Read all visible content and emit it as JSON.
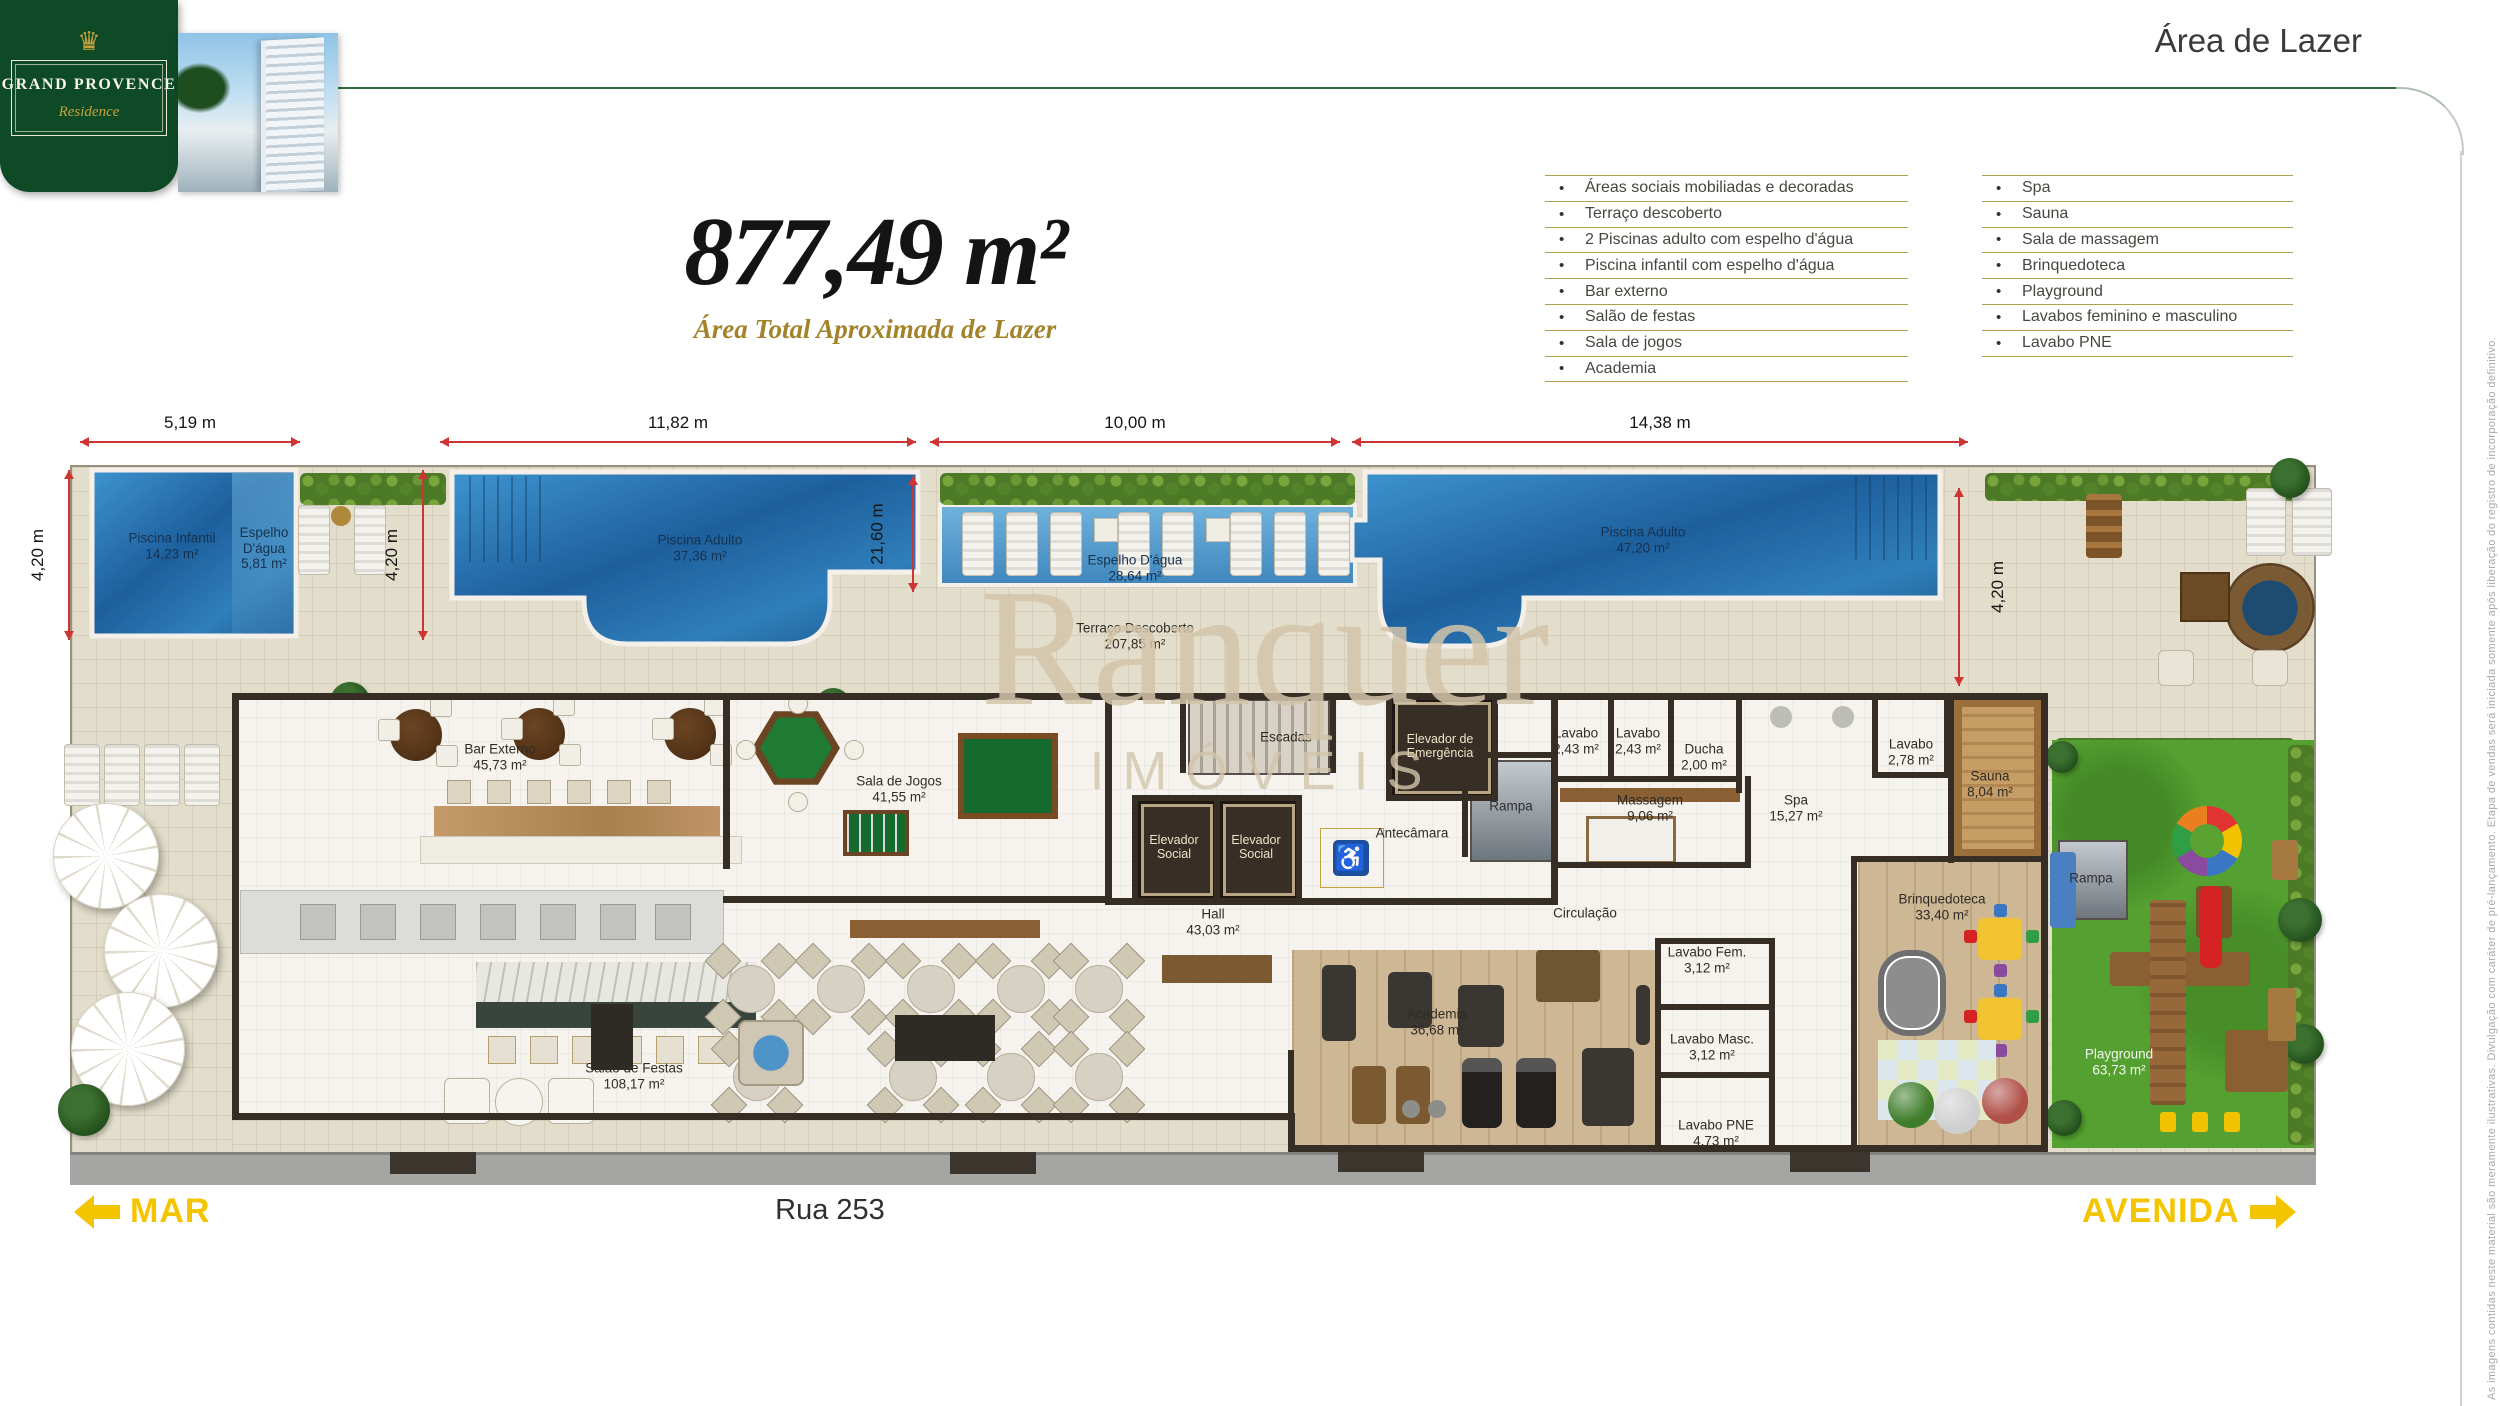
{
  "header": {
    "page_title": "Área de Lazer"
  },
  "logo": {
    "crown_glyph": "♛",
    "brand": "GRAND PROVENCE",
    "residence": "Residence"
  },
  "headline": {
    "total_area": "877,49 m²",
    "caption": "Área Total Aproximada de Lazer"
  },
  "features": {
    "left": [
      "Áreas sociais mobiliadas e decoradas",
      "Terraço descoberto",
      "2 Piscinas adulto com espelho d'água",
      "Piscina infantil com espelho d'água",
      "Bar externo",
      "Salão de festas",
      "Sala de jogos",
      "Academia"
    ],
    "right": [
      "Spa",
      "Sauna",
      "Sala de massagem",
      "Brinquedoteca",
      "Playground",
      "Lavabos feminino e masculino",
      "Lavabo PNE"
    ]
  },
  "dimensions": {
    "top": [
      {
        "label": "5,19 m",
        "x1": 80,
        "x2": 300
      },
      {
        "label": "11,82 m",
        "x1": 440,
        "x2": 916
      },
      {
        "label": "10,00 m",
        "x1": 930,
        "x2": 1340
      },
      {
        "label": "14,38 m",
        "x1": 1352,
        "x2": 1968
      }
    ],
    "vertical": [
      {
        "label": "4,20 m",
        "x": 68,
        "y1": 470,
        "y2": 640,
        "side": "left"
      },
      {
        "label": "4,20 m",
        "x": 422,
        "y1": 470,
        "y2": 640,
        "side": "left"
      },
      {
        "label": "21,60 m",
        "x": 912,
        "y1": 476,
        "y2": 592,
        "side": "left"
      },
      {
        "label": "4,20 m",
        "x": 1958,
        "y1": 488,
        "y2": 686,
        "side": "right"
      }
    ]
  },
  "plan": {
    "rooms": [
      {
        "label": "Piscina Infantil",
        "area": "14,23 m²",
        "x": 172,
        "y": 546,
        "cls": "water"
      },
      {
        "label": "Espelho D'água",
        "area": "5,81 m²",
        "x": 264,
        "y": 548,
        "cls": "water",
        "w": 70
      },
      {
        "label": "Piscina Adulto",
        "area": "37,36 m²",
        "x": 700,
        "y": 548,
        "cls": "water"
      },
      {
        "label": "Espelho D'água",
        "area": "28,64 m²",
        "x": 1135,
        "y": 568,
        "cls": "water"
      },
      {
        "label": "Terraço Descoberto",
        "area": "207,85 m²",
        "x": 1135,
        "y": 636
      },
      {
        "label": "Piscina Adulto",
        "area": "47,20 m²",
        "x": 1643,
        "y": 540,
        "cls": "water"
      },
      {
        "label": "Bar Externo",
        "area": "45,73 m²",
        "x": 500,
        "y": 757
      },
      {
        "label": "Sala de Jogos",
        "area": "41,55 m²",
        "x": 899,
        "y": 789
      },
      {
        "label": "Escadas",
        "x": 1286,
        "y": 737
      },
      {
        "label": "Elevador de Emergência",
        "x": 1440,
        "y": 746,
        "cls": "cream",
        "w": 88
      },
      {
        "label": "Elevador Social",
        "x": 1174,
        "y": 847,
        "cls": "cream",
        "w": 66
      },
      {
        "label": "Elevador Social",
        "x": 1256,
        "y": 847,
        "cls": "cream",
        "w": 66
      },
      {
        "label": "Antecâmara",
        "x": 1412,
        "y": 833
      },
      {
        "label": "Rampa",
        "x": 1511,
        "y": 806,
        "cls": "ramp"
      },
      {
        "label": "Hall",
        "area": "43,03 m²",
        "x": 1213,
        "y": 922
      },
      {
        "label": "Lavabo",
        "area": "2,43 m²",
        "x": 1576,
        "y": 741,
        "w": 60
      },
      {
        "label": "Lavabo",
        "area": "2,43 m²",
        "x": 1638,
        "y": 741,
        "w": 60
      },
      {
        "label": "Ducha",
        "area": "2,00 m²",
        "x": 1704,
        "y": 757,
        "w": 62
      },
      {
        "label": "Massagem",
        "area": "9,06 m²",
        "x": 1650,
        "y": 808
      },
      {
        "label": "Spa",
        "area": "15,27 m²",
        "x": 1796,
        "y": 808
      },
      {
        "label": "Lavabo",
        "area": "2,78 m²",
        "x": 1911,
        "y": 752,
        "w": 60
      },
      {
        "label": "Sauna",
        "area": "8,04 m²",
        "x": 1990,
        "y": 784
      },
      {
        "label": "Circulação",
        "x": 1585,
        "y": 913
      },
      {
        "label": "Brinquedoteca",
        "area": "33,40 m²",
        "x": 1942,
        "y": 907
      },
      {
        "label": "Lavabo Fem.",
        "area": "3,12 m²",
        "x": 1707,
        "y": 960,
        "w": 92
      },
      {
        "label": "Lavabo Masc.",
        "area": "3,12 m²",
        "x": 1712,
        "y": 1047,
        "w": 104
      },
      {
        "label": "Lavabo PNE",
        "area": "4,73 m²",
        "x": 1716,
        "y": 1133,
        "w": 104
      },
      {
        "label": "Academia",
        "area": "36,68 m²",
        "x": 1437,
        "y": 1022
      },
      {
        "label": "Salão de Festas",
        "area": "108,17 m²",
        "x": 634,
        "y": 1076
      },
      {
        "label": "Playground",
        "area": "63,73 m²",
        "x": 2119,
        "y": 1062,
        "cls": "white"
      },
      {
        "label": "Rampa",
        "x": 2091,
        "y": 878,
        "cls": "ramp"
      }
    ]
  },
  "watermark": {
    "line1": "Ranquer",
    "line2": "IMÓVEIS"
  },
  "footer": {
    "mar": "MAR",
    "street": "Rua 253",
    "avenida": "AVENIDA"
  },
  "disclaimer": "As imagens contidas neste material são meramente ilustrativas. Divulgação com caráter de pré-lançamento. Etapa de vendas será iniciada somente após liberação do registro de incorporação definitivo.",
  "colors": {
    "brand_green": "#0e4a26",
    "accent_gold": "#b29f4d",
    "dimension_red": "#cf3434",
    "highlight_yellow": "#f5c400",
    "water_blue": "#2f7fba",
    "lawn_green": "#54a030"
  }
}
